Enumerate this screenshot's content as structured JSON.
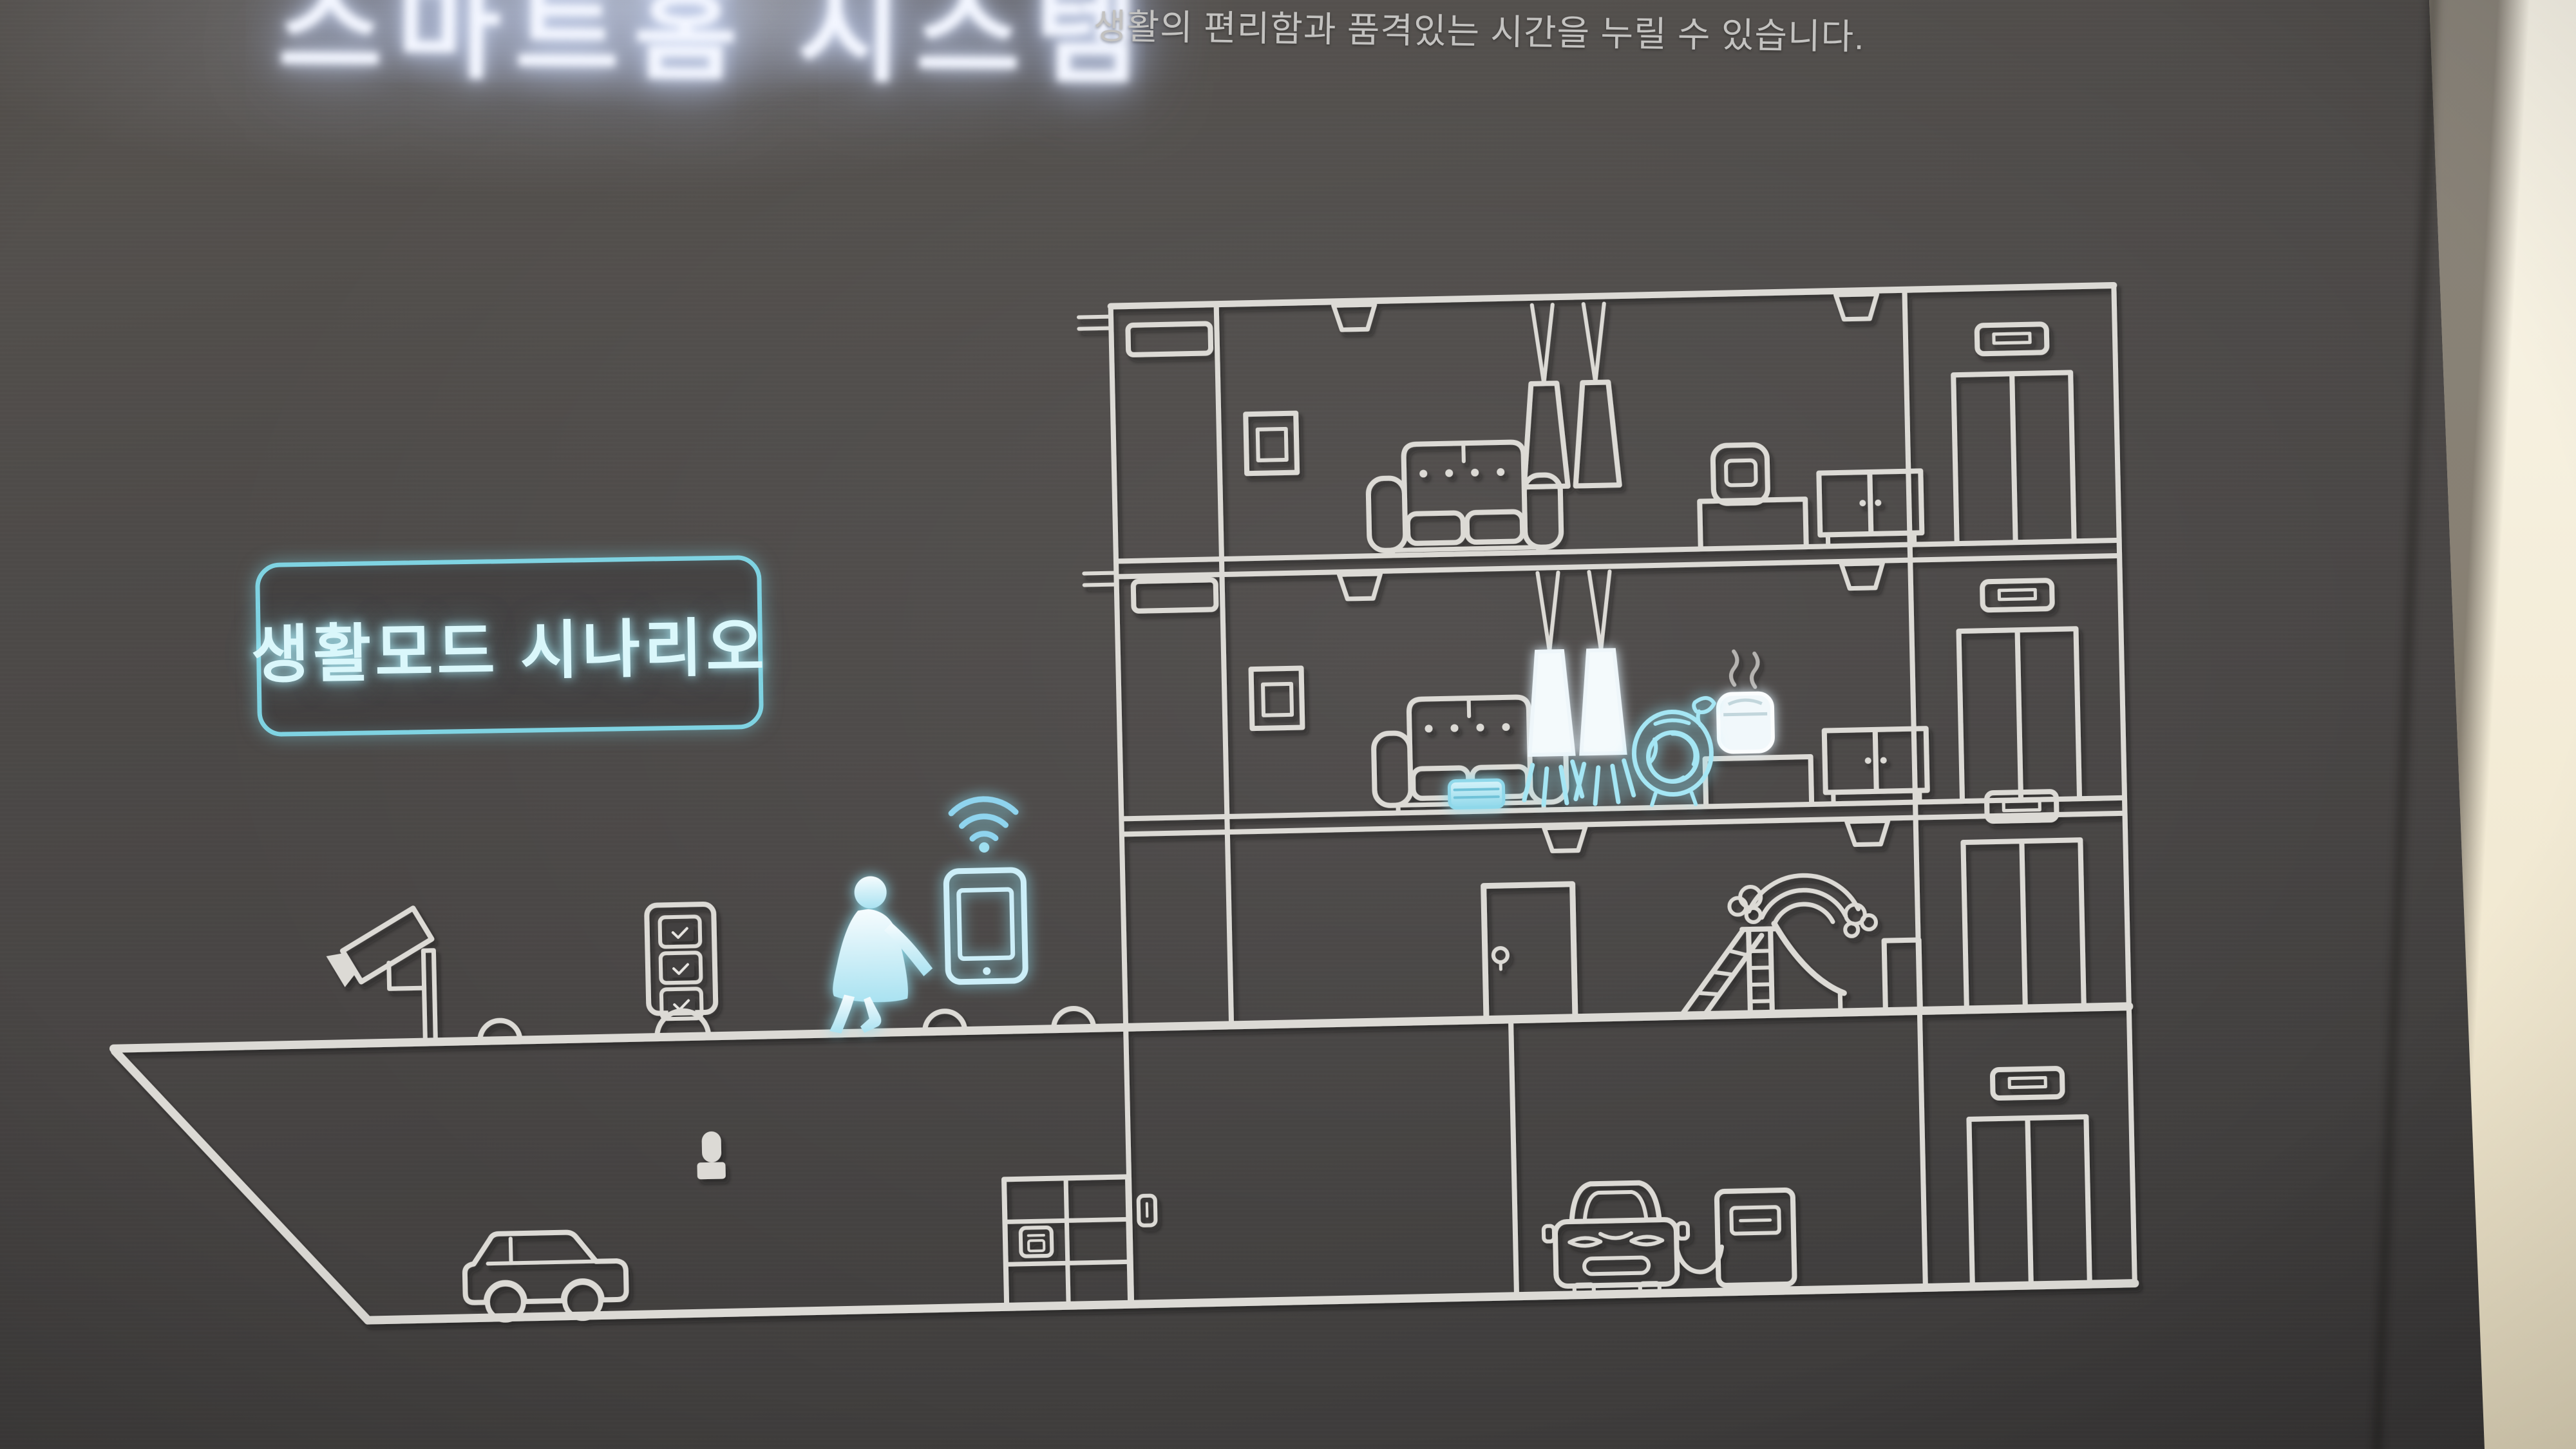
{
  "sign": {
    "glow_title": "스마트홈 시스템",
    "description": "생활의 편리함과 품격있는 시간을 누릴 수 있습니다.",
    "scenario_box_label": "생활모드 시나리오"
  },
  "colors": {
    "panel_background": "#4a4745",
    "line_art": "#dcdad5",
    "accent_cyan": "#8fdcec",
    "box_border": "#7fd3e2",
    "box_text": "#daf7fb",
    "side_wall": "#f3ecd8"
  },
  "diagram": {
    "type": "building-cross-section",
    "icons": [
      {
        "name": "cctv-camera",
        "state": "outline"
      },
      {
        "name": "access-kiosk",
        "state": "outline"
      },
      {
        "name": "speed-bumps",
        "state": "outline"
      },
      {
        "name": "walking-person",
        "state": "lit"
      },
      {
        "name": "smartphone",
        "state": "lit"
      },
      {
        "name": "wifi-signal",
        "state": "lit"
      },
      {
        "name": "wall-tv-upper",
        "state": "outline"
      },
      {
        "name": "pendant-lights-upper",
        "state": "outline"
      },
      {
        "name": "sofa-upper",
        "state": "outline"
      },
      {
        "name": "rice-cooker-upper",
        "state": "outline"
      },
      {
        "name": "sideboard-upper",
        "state": "outline"
      },
      {
        "name": "wall-tv-middle",
        "state": "outline"
      },
      {
        "name": "pendant-lights-middle",
        "state": "lit"
      },
      {
        "name": "sofa-middle",
        "state": "outline"
      },
      {
        "name": "robot-vacuum",
        "state": "lit"
      },
      {
        "name": "air-purifier",
        "state": "lit"
      },
      {
        "name": "rice-cooker-middle",
        "state": "lit"
      },
      {
        "name": "sideboard-middle",
        "state": "outline"
      },
      {
        "name": "entrance-door",
        "state": "outline"
      },
      {
        "name": "playground-slide",
        "state": "outline"
      },
      {
        "name": "rainbow-clouds",
        "state": "outline"
      },
      {
        "name": "garden-bench",
        "state": "outline"
      },
      {
        "name": "elevator-upper",
        "state": "outline"
      },
      {
        "name": "elevator-middle",
        "state": "outline"
      },
      {
        "name": "elevator-ground",
        "state": "outline"
      },
      {
        "name": "elevator-basement",
        "state": "outline"
      },
      {
        "name": "parking-car",
        "state": "outline"
      },
      {
        "name": "wall-sensor",
        "state": "outline"
      },
      {
        "name": "parcel-locker",
        "state": "outline"
      },
      {
        "name": "ev-car",
        "state": "outline"
      },
      {
        "name": "ev-charger",
        "state": "outline"
      }
    ]
  }
}
